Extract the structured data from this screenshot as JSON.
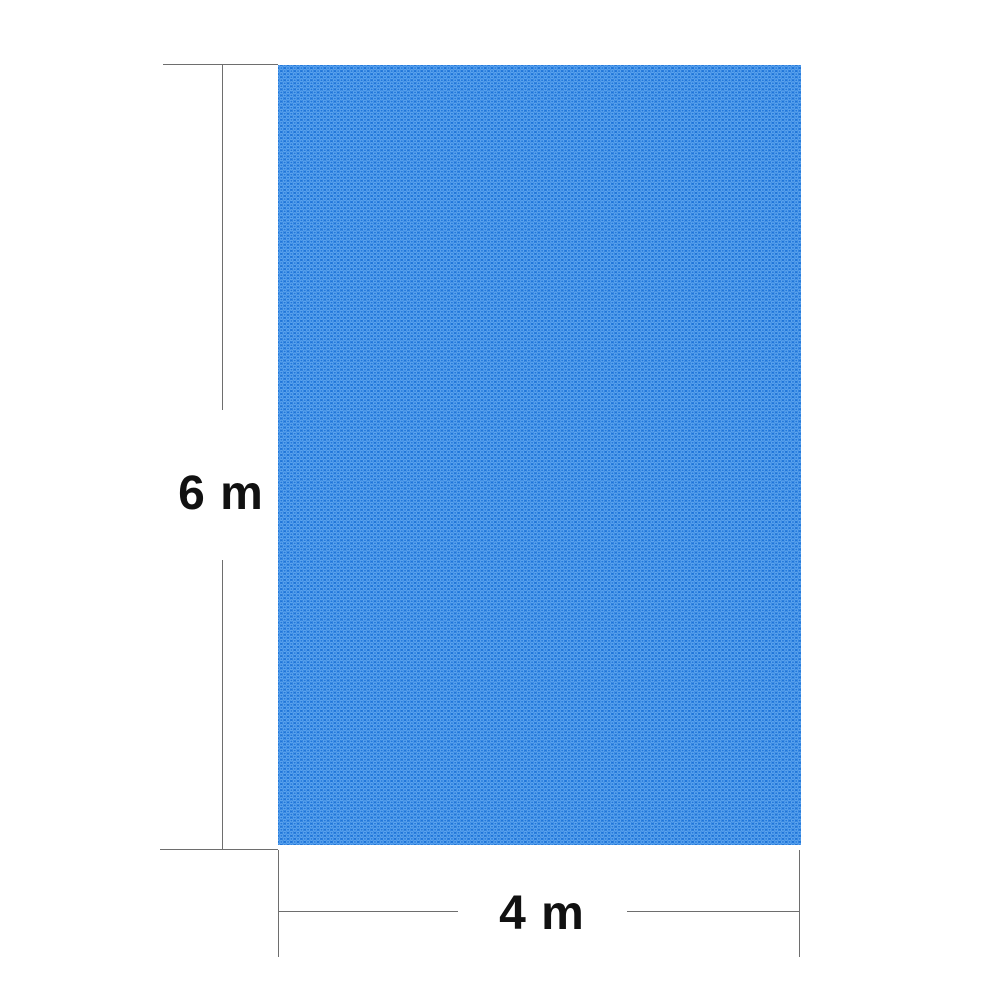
{
  "title": "Pool cover dimension diagram",
  "diagram": {
    "height_label": "6 m",
    "width_label": "4 m"
  },
  "colors": {
    "background": "#ffffff",
    "cover_base": "#1e74d8",
    "cover_bubble": "#8cc9ff",
    "dim_line": "#6e6e6e",
    "label_text": "#111111"
  }
}
